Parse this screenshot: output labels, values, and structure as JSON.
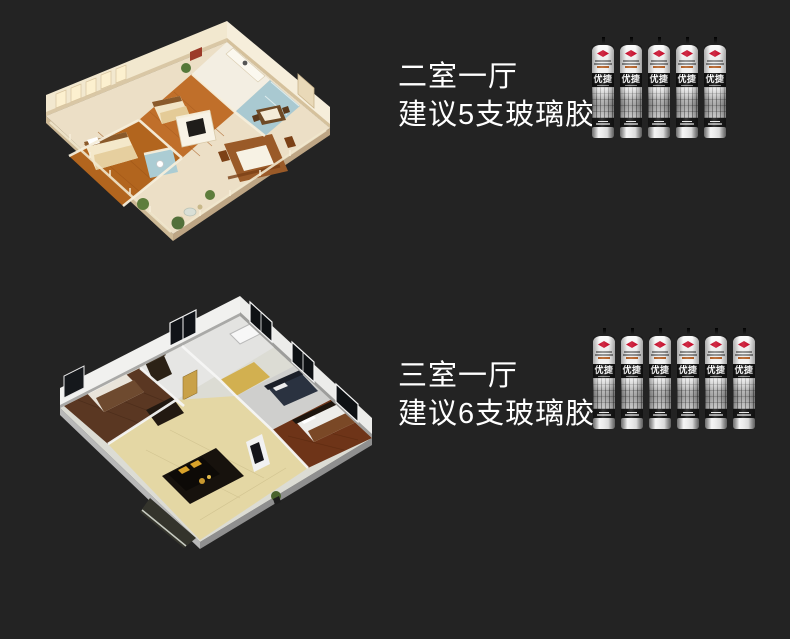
{
  "page": {
    "background": "#232323",
    "text_color": "#ffffff"
  },
  "sections": [
    {
      "id": "two-bedroom",
      "title": "二室一厅",
      "subtitle": "建议5支玻璃胶",
      "tube_count": 5
    },
    {
      "id": "three-bedroom",
      "title": "三室一厅",
      "subtitle": "建议6支玻璃胶",
      "tube_count": 6
    }
  ],
  "product": {
    "brand_label": "优捷",
    "logo_icon": "diamond-logo",
    "logo_color": "#c8102e",
    "cap_color": "#111111",
    "label_band_color": "#141414"
  }
}
